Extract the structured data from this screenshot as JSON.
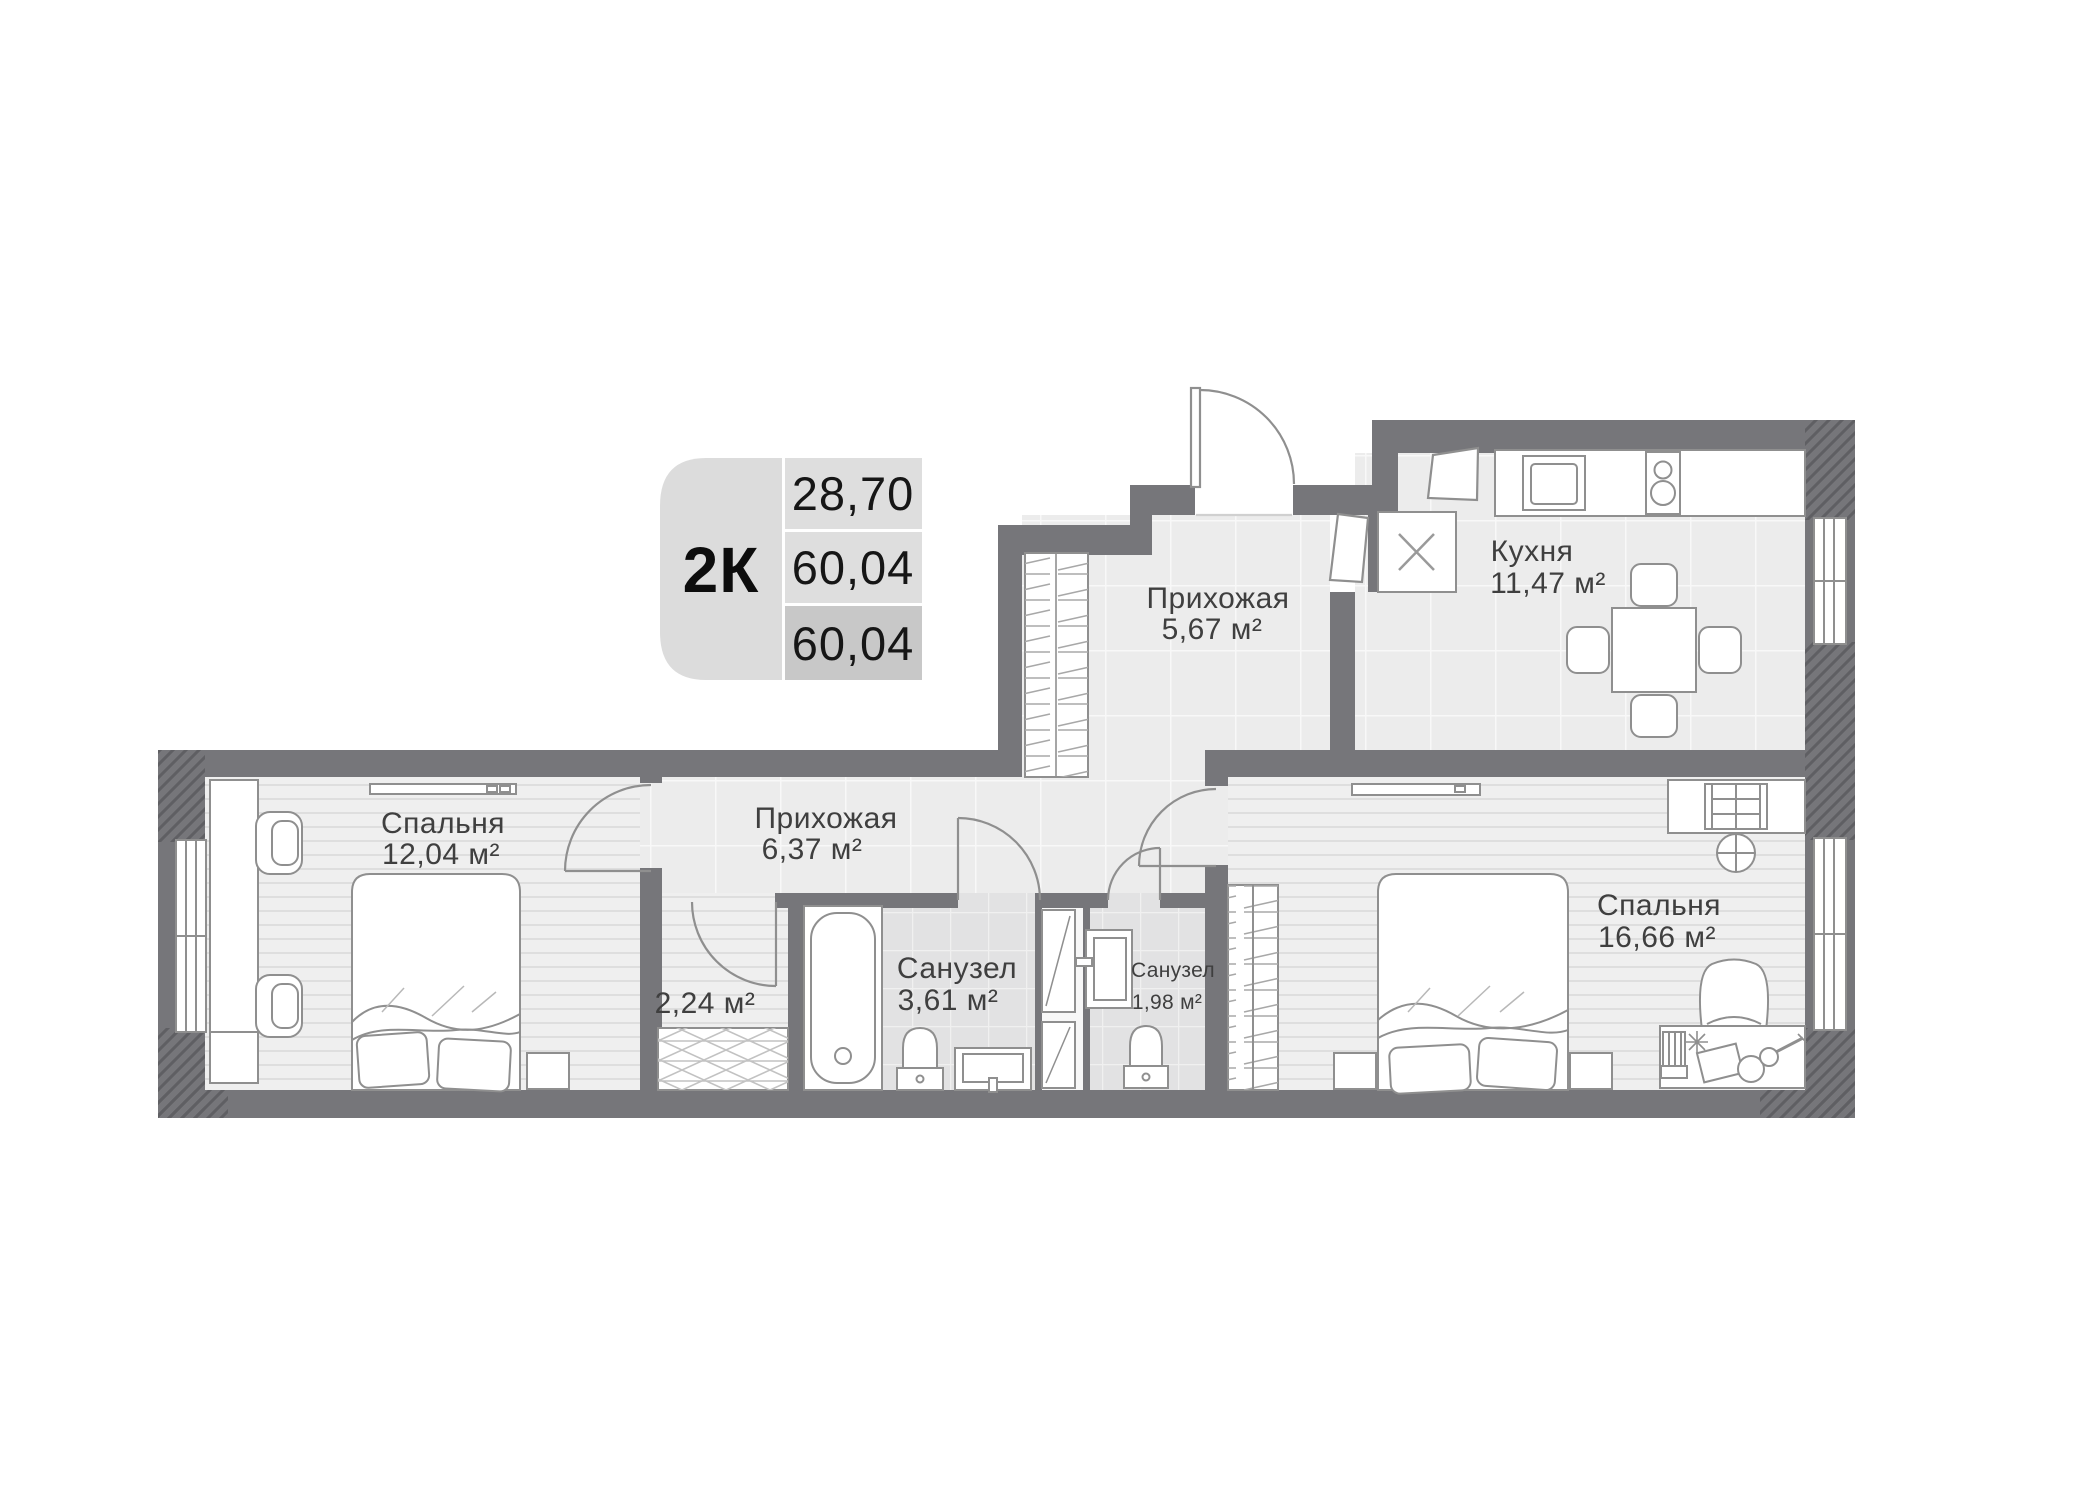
{
  "badge": {
    "type": "2К",
    "values": [
      "28,70",
      "60,04",
      "60,04"
    ]
  },
  "rooms": {
    "bedroom1": {
      "name": "Спальня",
      "area": "12,04 м²"
    },
    "corridor": {
      "name": "Прихожая",
      "area": "6,37 м²"
    },
    "hall": {
      "name": "Прихожая",
      "area": "5,67 м²"
    },
    "kitchen": {
      "name": "Кухня",
      "area": "11,47 м²"
    },
    "bath_main": {
      "name": "Санузел",
      "area": "3,61 м²"
    },
    "storage": {
      "area": "2,24 м²"
    },
    "bath_small": {
      "name": "Санузел",
      "area": "1,98 м²"
    },
    "bedroom2": {
      "name": "Спальня",
      "area": "16,66 м²"
    }
  },
  "colors": {
    "wall": "#76767a",
    "wall_hatch": "#5f5f63",
    "floor_tile": "#ececec",
    "floor_bath": "#e2e2e3",
    "floor_wood": "#efefef",
    "badge_cell": "#dcdcdc",
    "badge_cell_dark": "#c8c8c8",
    "outline": "#8f8f8f",
    "text": "#3f3f3f"
  }
}
